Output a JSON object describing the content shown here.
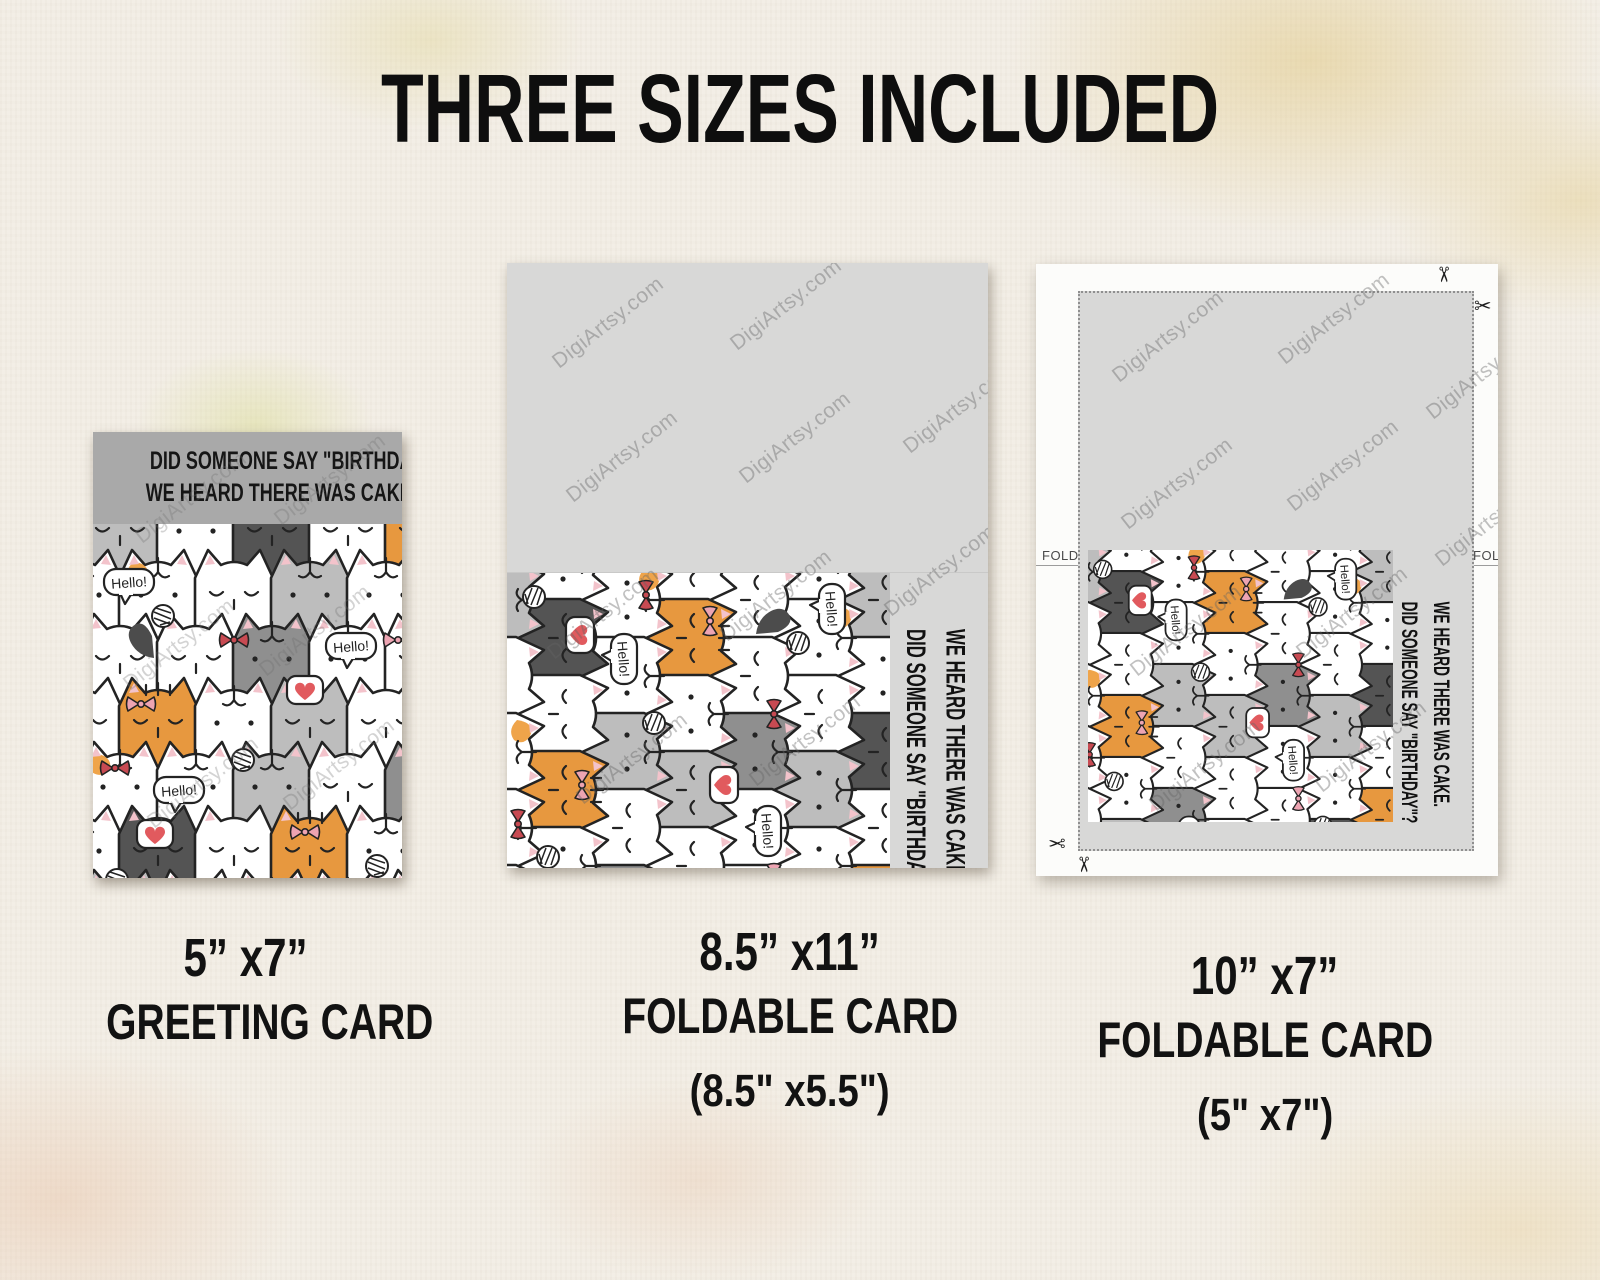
{
  "title": "THREE SIZES INCLUDED",
  "watermark": "DigiArtsy.com",
  "front_text": {
    "line1": "DID SOMEONE SAY \"BIRTHDAY\"?",
    "line2": "WE HEARD THERE WAS CAKE."
  },
  "pattern": {
    "speech_text": "Hello!"
  },
  "fold_label": "FOLD",
  "icons": {
    "scissors_glyph": "✂"
  },
  "labels": [
    {
      "size": "5” x7”",
      "type": "GREETING CARD",
      "folded": ""
    },
    {
      "size": "8.5” x11”",
      "type": "FOLDABLE CARD",
      "folded": "(8.5\" x5.5\")"
    },
    {
      "size": "10” x7”",
      "type": "FOLDABLE CARD",
      "folded": "(5\" x7\")"
    }
  ],
  "colors": {
    "header_gray": "#a9a9a9",
    "blank_gray": "#d8d8d7",
    "cat_orange": "#e7983f",
    "cat_gray": "#bdbdbd",
    "cat_dark": "#545454",
    "bow_red": "#c84a52",
    "bow_pink": "#eda4b2",
    "heart_red": "#e15a5e",
    "text_black": "#111111",
    "paper_bg": "#f3eee5"
  }
}
